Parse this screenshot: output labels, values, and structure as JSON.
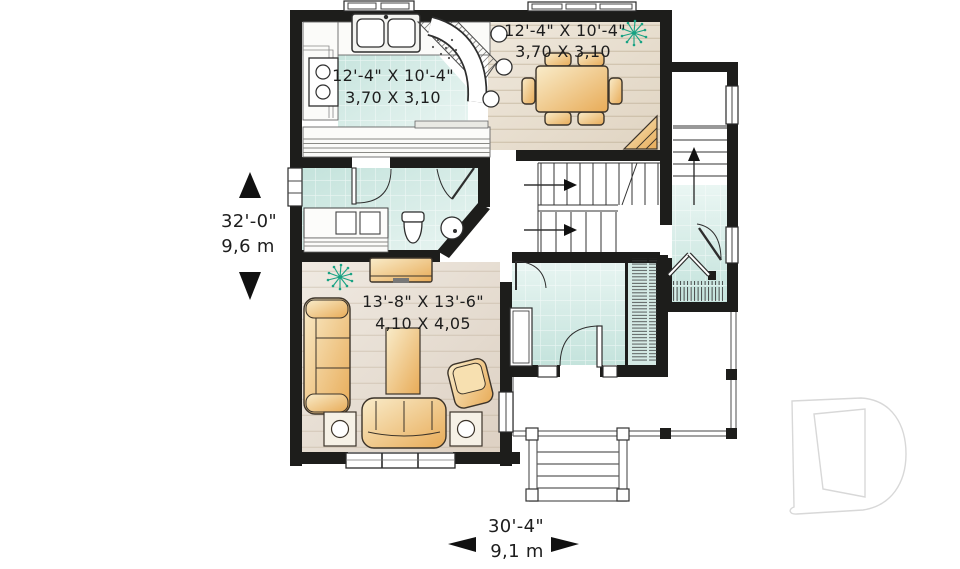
{
  "rooms": {
    "kitchen": {
      "imperial": "12'-4\" X 10'-4\"",
      "metric": "3,70 X 3,10"
    },
    "dining": {
      "imperial": "12'-4\" X 10'-4\"",
      "metric": "3,70 X 3,10"
    },
    "living": {
      "imperial": "13'-8\" X 13'-6\"",
      "metric": "4,10 X 4,05"
    }
  },
  "dimensions": {
    "overall_depth": {
      "imperial": "32'-0\"",
      "metric": "9,6 m"
    },
    "overall_width": {
      "imperial": "30'-4\"",
      "metric": "9,1 m"
    }
  },
  "icons": {
    "plant": "plant-icon",
    "up_arrow": "▲",
    "down_arrow": "▼",
    "left_arrow": "◀",
    "right_arrow": "▶",
    "stair_direction_arrow": "→"
  },
  "colors": {
    "wall": "#1d1d1b",
    "tile_floor": "#c9e5df",
    "wood_floor": "#eae2d6",
    "living_floor": "#e7ddd1",
    "furniture": "#eebd74",
    "plant": "#18a283",
    "watermark_outline": "#d8d8d8"
  }
}
